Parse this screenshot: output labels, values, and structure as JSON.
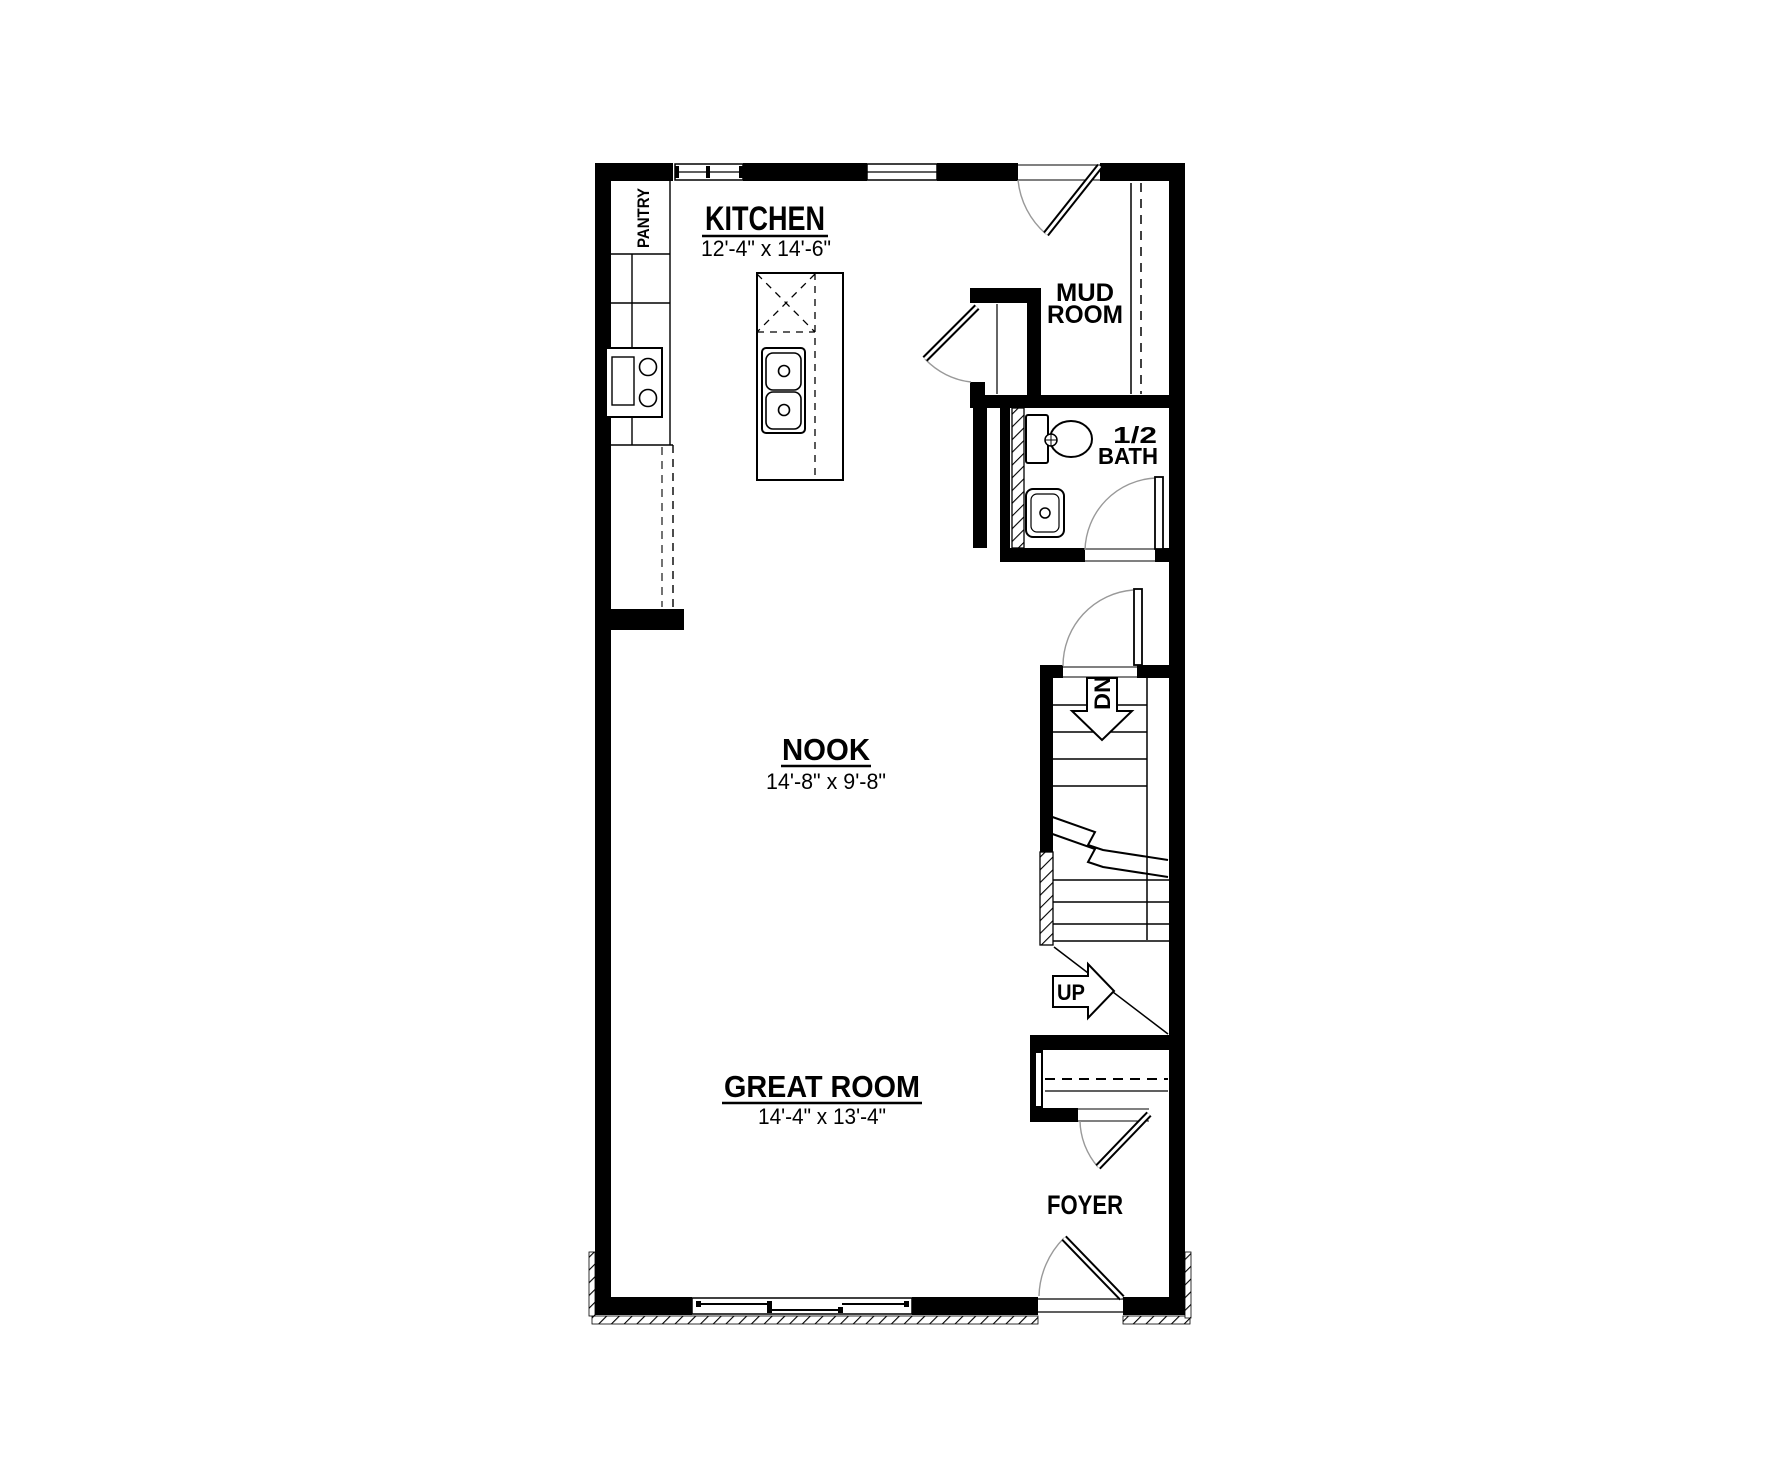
{
  "plan": {
    "type": "floor-plan",
    "floor": "main",
    "rooms": {
      "kitchen": {
        "label": "KITCHEN",
        "dims": "12'-4\" x 14'-6\""
      },
      "nook": {
        "label": "NOOK",
        "dims": "14'-8\" x 9'-8\""
      },
      "great_room": {
        "label": "GREAT ROOM",
        "dims": "14'-4\" x 13'-4\""
      },
      "mud_room": {
        "line1": "MUD",
        "line2": "ROOM"
      },
      "half_bath": {
        "line1": "1/2",
        "line2": "BATH"
      },
      "foyer": {
        "label": "FOYER"
      },
      "pantry": {
        "label": "PANTRY"
      }
    },
    "stairs": {
      "up_label": "UP",
      "down_label": "DN"
    },
    "colors": {
      "wall": "#000000",
      "background": "#ffffff",
      "arc": "#999999"
    },
    "fixtures": [
      "kitchen-island-double-sink",
      "range",
      "refrigerator",
      "pantry-cabinets",
      "toilet",
      "pedestal-sink",
      "mud-room-shelf",
      "coat-closet-rod-and-shelf"
    ]
  }
}
